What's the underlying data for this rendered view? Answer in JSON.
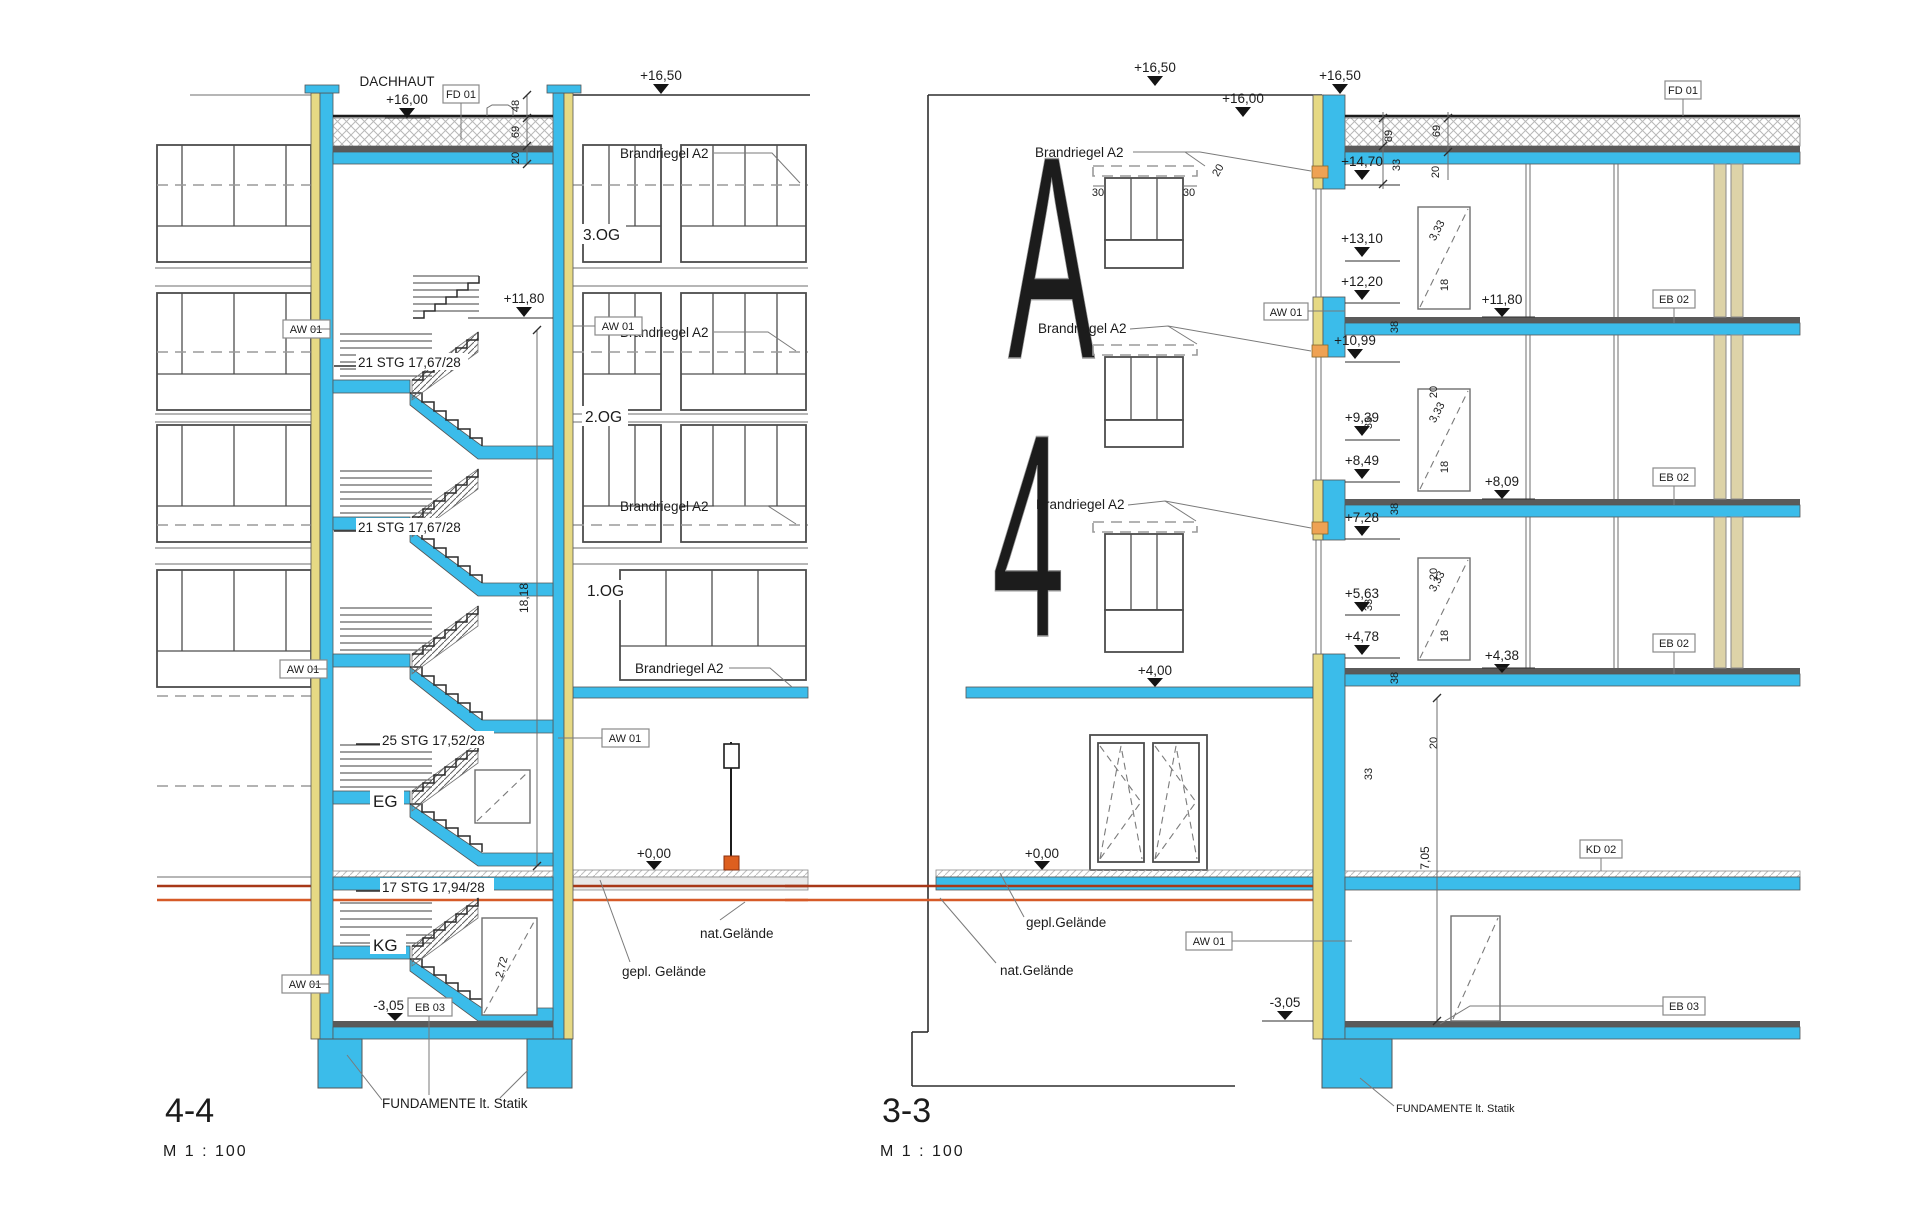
{
  "colors": {
    "slab_cyan": "#3bbcea",
    "insulation_yellow": "#e6d984",
    "firestop_orange": "#efa253",
    "lamp_orange": "#dd5f1f",
    "terrain_red_dark": "#a83818",
    "terrain_red_light": "#d65a28"
  },
  "left": {
    "title": "4-4",
    "scale": "M  1 : 100",
    "dachhaut": "DACHHAUT",
    "fd01": "FD 01",
    "lv_1650": "+16,50",
    "lv_1600": "+16,00",
    "lv_1180": "+11,80",
    "lv_000": "+0,00",
    "lv_m305": "-3,05",
    "brandriegel": "Brandriegel A2",
    "aw01": "AW 01",
    "eb03": "EB 03",
    "og3": "3.OG",
    "og2": "2.OG",
    "og1": "1.OG",
    "eg": "EG",
    "kg": "KG",
    "stg21": "21 STG 17,67/28",
    "stg25": "25 STG 17,52/28",
    "stg17": "17 STG 17,94/28",
    "dim_48": "48",
    "dim_69": "69",
    "dim_20": "20",
    "dim_1818": "18,18",
    "dim_272": "2,72",
    "nat_gelaende": "nat.Gelände",
    "gepl_gelaende": "gepl. Gelände",
    "fundamente": "FUNDAMENTE lt. Statik"
  },
  "right": {
    "title": "3-3",
    "scale": "M  1 : 100",
    "fd01": "FD 01",
    "kd02": "KD 02",
    "eb02": "EB 02",
    "eb03": "EB 03",
    "aw01": "AW 01",
    "lv_1650": "+16,50",
    "lv_1600": "+16,00",
    "lv_1470": "+14,70",
    "lv_1310": "+13,10",
    "lv_1220": "+12,20",
    "lv_1180": "+11,80",
    "lv_1099": "+10,99",
    "lv_939": "+9,39",
    "lv_849": "+8,49",
    "lv_809": "+8,09",
    "lv_728": "+7,28",
    "lv_563": "+5,63",
    "lv_478": "+4,78",
    "lv_438": "+4,38",
    "lv_400": "+4,00",
    "lv_000": "+0,00",
    "lv_m305": "-3,05",
    "brandriegel": "Brandriegel A2",
    "dim_89": "89",
    "dim_69": "69",
    "dim_33": "33",
    "dim_20": "20",
    "dim_30": "30",
    "dim_38": "38",
    "dim_18": "18",
    "dim_333": "3,33",
    "dim_705": "7,05",
    "letter_a": "A",
    "letter_4": "4",
    "nat_gelaende": "nat.Gelände",
    "gepl_gelaende": "gepl.Gelände",
    "fundamente": "FUNDAMENTE lt. Statik"
  }
}
